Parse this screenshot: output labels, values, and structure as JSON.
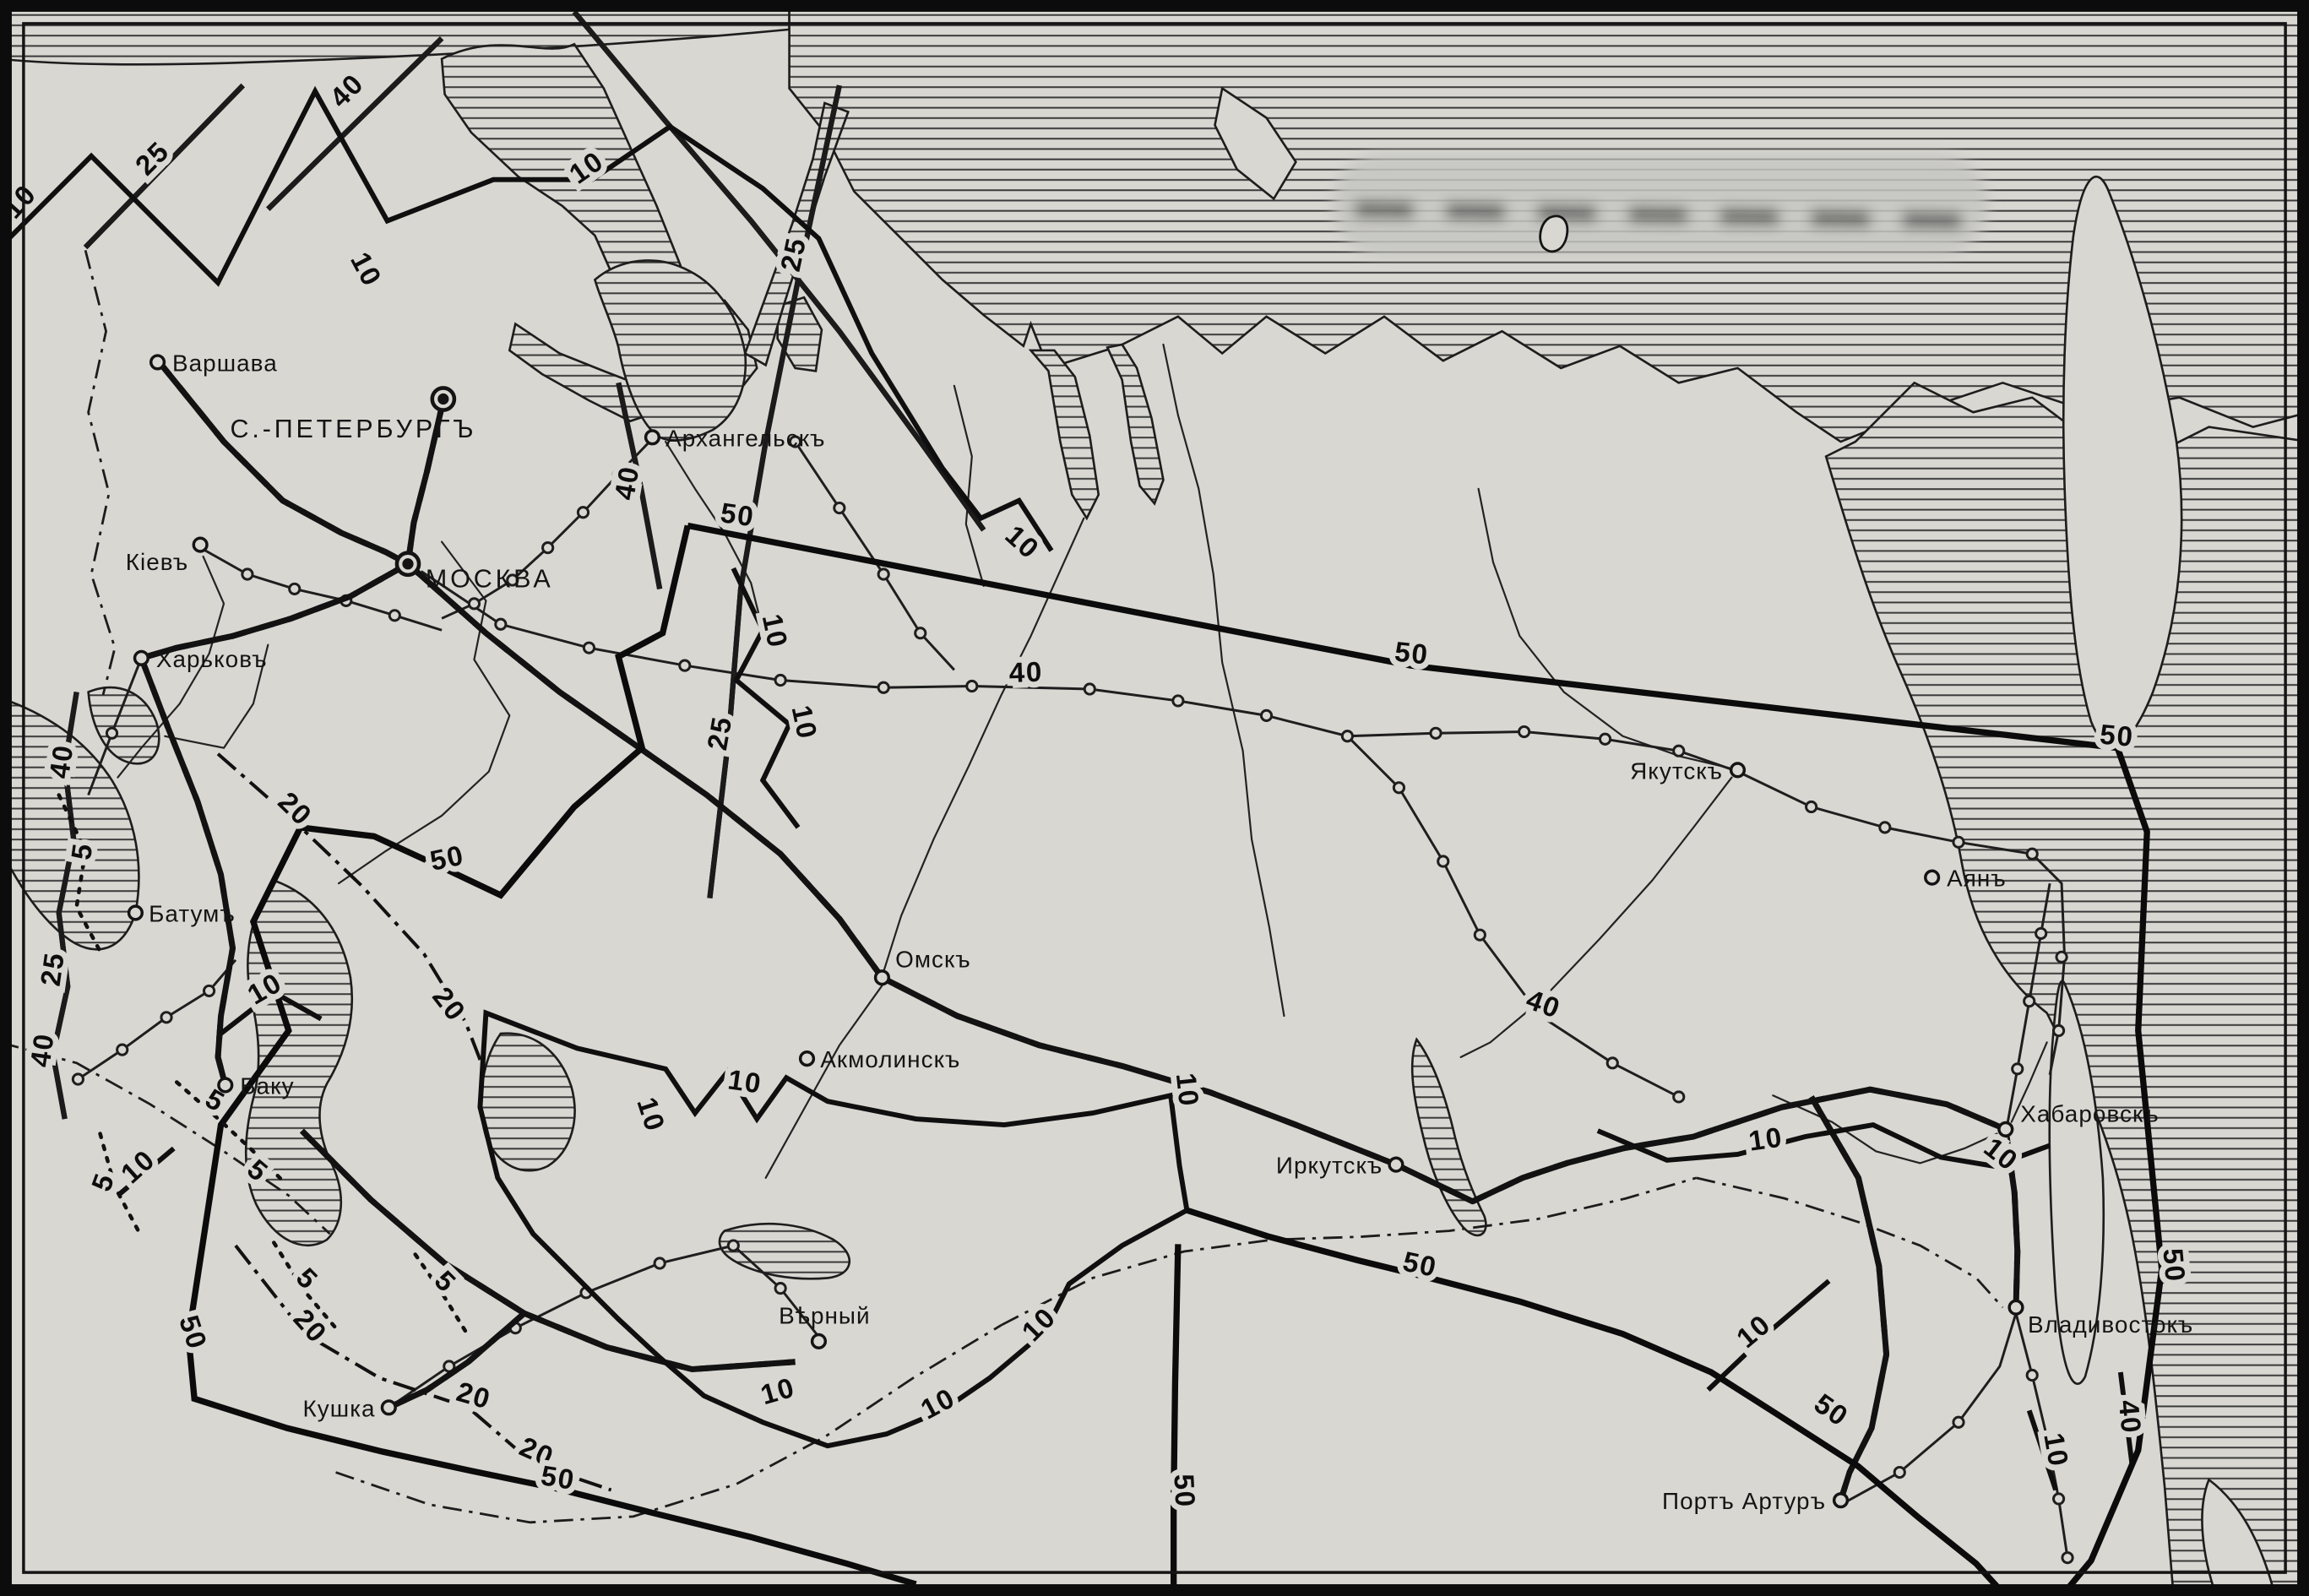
{
  "map": {
    "region": "Russian Empire travel-time map (pre-revolutionary orthography)",
    "cities": [
      {
        "label": "Варшава",
        "marker": "town"
      },
      {
        "label": "С.-ПЕТЕРБУРГЪ",
        "marker": "capital"
      },
      {
        "label": "МОСКВА",
        "marker": "capital"
      },
      {
        "label": "Кіевъ",
        "marker": "town"
      },
      {
        "label": "Харьковъ",
        "marker": "town"
      },
      {
        "label": "Архангельскъ",
        "marker": "town"
      },
      {
        "label": "Батумъ",
        "marker": "town"
      },
      {
        "label": "Баку",
        "marker": "town"
      },
      {
        "label": "Омскъ",
        "marker": "town"
      },
      {
        "label": "Акмолинскъ",
        "marker": "town"
      },
      {
        "label": "Вѣрный",
        "marker": "town"
      },
      {
        "label": "Кушка",
        "marker": "town"
      },
      {
        "label": "Иркутскъ",
        "marker": "town"
      },
      {
        "label": "Якутскъ",
        "marker": "town"
      },
      {
        "label": "Аянъ",
        "marker": "town"
      },
      {
        "label": "Хабаровскъ",
        "marker": "town"
      },
      {
        "label": "Владивостокъ",
        "marker": "town"
      },
      {
        "label": "Портъ Артуръ",
        "marker": "town"
      }
    ],
    "isolines": {
      "5": "5",
      "10": "10",
      "20": "20",
      "25": "25",
      "40": "40",
      "50": "50"
    },
    "isoline_values_days": [
      5,
      10,
      20,
      25,
      40,
      50
    ],
    "colors": {
      "paper": "#d8d7d2",
      "ink": "#141414"
    }
  }
}
